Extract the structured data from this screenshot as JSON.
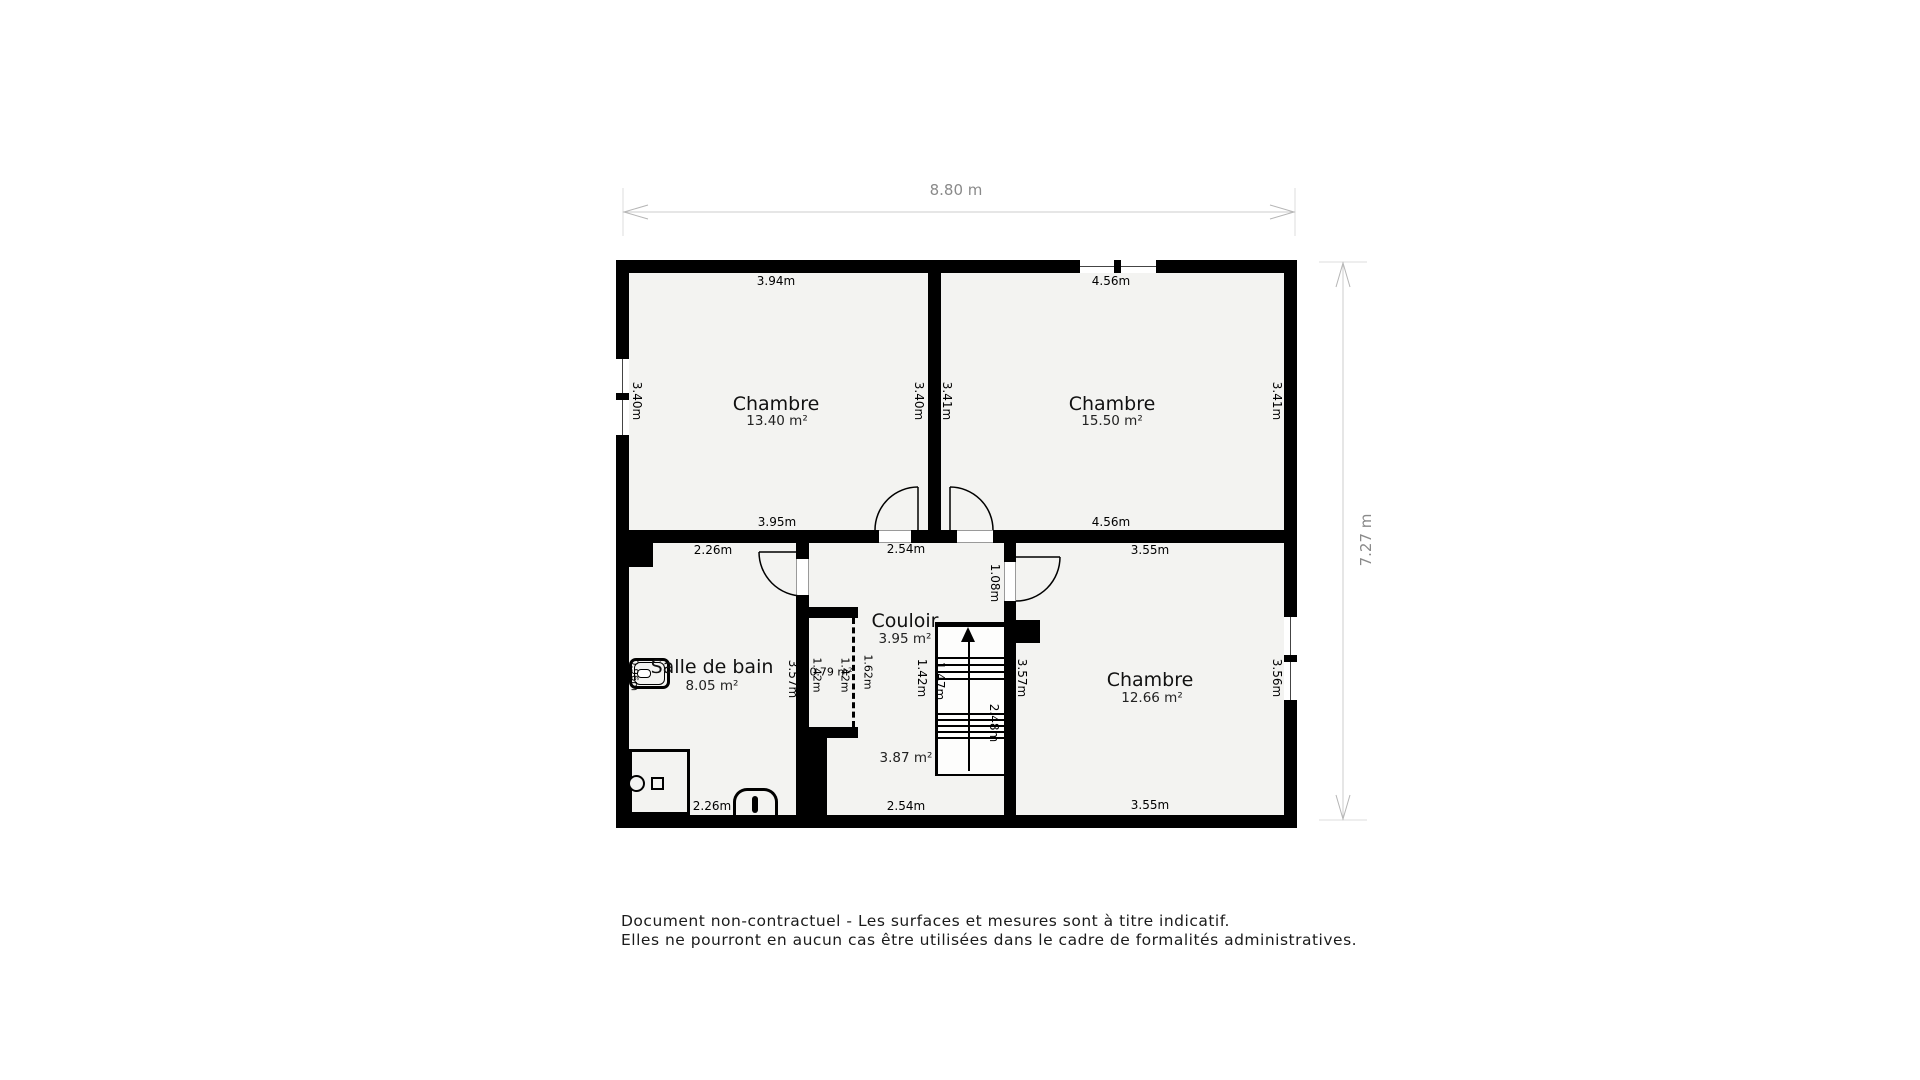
{
  "overall": {
    "width": "8.80 m",
    "height": "7.27 m"
  },
  "rooms": {
    "bedroom_top_left": {
      "name": "Chambre",
      "area": "13.40 m²",
      "dim_top": "3.94m",
      "dim_bottom": "3.95m",
      "dim_left": "3.40m",
      "dim_right": "3.40m"
    },
    "bedroom_top_right": {
      "name": "Chambre",
      "area": "15.50 m²",
      "dim_top": "4.56m",
      "dim_bottom": "4.56m",
      "dim_left": "3.41m",
      "dim_right": "3.41m"
    },
    "bathroom": {
      "name": "Salle de bain",
      "area": "8.05 m²",
      "dim_top": "2.26m",
      "dim_bottom": "2.26m",
      "dim_right": "3.57m",
      "dim_fixture": "0.96m"
    },
    "hallway": {
      "name": "Couloir",
      "area": "3.95 m²",
      "dim_top": "2.54m",
      "dim_bottom": "2.54m",
      "dim_door": "1.08m"
    },
    "bedroom_bottom_right": {
      "name": "Chambre",
      "area": "12.66 m²",
      "dim_top": "3.55m",
      "dim_bottom": "3.55m",
      "dim_left": "3.57m",
      "dim_right": "3.56m"
    },
    "closet": {
      "area": "0.79 m²",
      "dim_inner": "1.42m",
      "dim_outer": "1.42m",
      "dim_opening": "1.62m"
    },
    "staircase": {
      "area": "3.87 m²",
      "dim_side": "1.42m",
      "dim_width": "1.47m",
      "dim_run": "2.48m"
    }
  },
  "footer": {
    "line1": "Document non-contractuel - Les surfaces et mesures sont à titre indicatif.",
    "line2": "Elles ne pourront en aucun cas être utilisées dans le cadre de formalités administratives."
  }
}
